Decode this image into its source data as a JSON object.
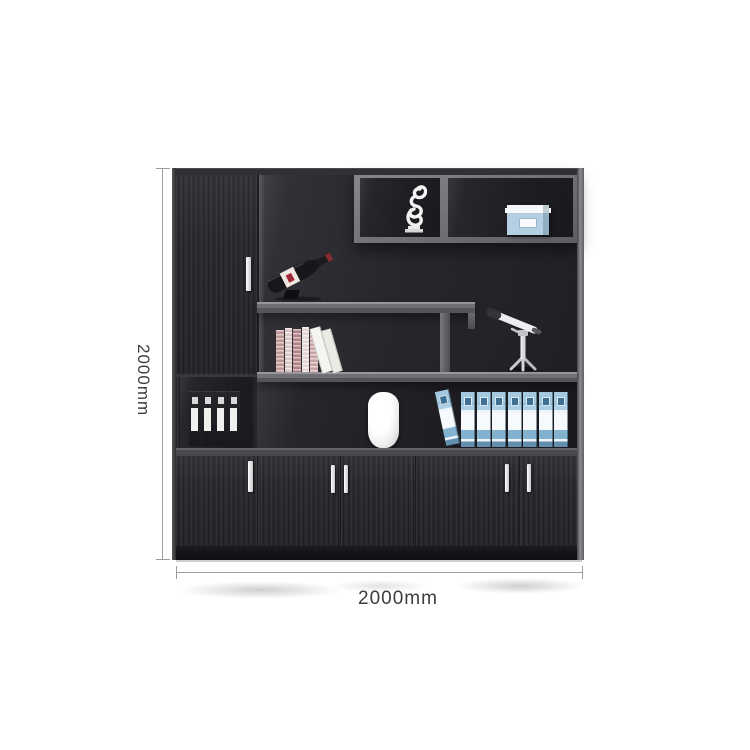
{
  "scene": {
    "type": "furniture-product-photo",
    "background_color": "#ffffff",
    "subject": "black office bookcase filing cabinet with open display shelves and doors"
  },
  "dimensions": {
    "height_label": "2000mm",
    "width_label": "2000mm",
    "height_mm": 2000,
    "width_mm": 2000,
    "line_color": "#9e9e9e",
    "label_color": "#3d3d3d"
  },
  "cabinet": {
    "body_color": "#2a2a2e",
    "shelf_frame_color": "#6f6f75",
    "interior_color": "#232328",
    "handle_color": "#f2f2f2",
    "plinth_color": "#141417",
    "door_count": 5,
    "handle_count": 5,
    "items": [
      {
        "name": "abstract-sculpture",
        "color": "#f4f4f4",
        "location": "top-shelf-left-cell"
      },
      {
        "name": "blue-storage-box",
        "color": "#b4cfe2",
        "location": "top-shelf-right-cell"
      },
      {
        "name": "wine-bottle",
        "color": "#17171b",
        "label_color": "#ede7df",
        "pose": "tilted-on-stand",
        "location": "upper-left-compartment"
      },
      {
        "name": "book-row",
        "count": 7,
        "colors": [
          "#c79e9e",
          "#e7cfcf",
          "#b9898c",
          "#f0e0e0",
          "#f4f4f1"
        ],
        "location": "middle-left-shelf"
      },
      {
        "name": "telescope-model",
        "color": "#ededf0",
        "location": "middle-right-shelf"
      },
      {
        "name": "black-binders",
        "count": 4,
        "color": "#1c1c20",
        "location": "left-open-compartment"
      },
      {
        "name": "white-vase",
        "color": "#fafafa",
        "location": "lower-shelf-left"
      },
      {
        "name": "blue-binders",
        "count": 8,
        "color": "#a9cde4",
        "pose": "first-leaning",
        "location": "lower-shelf-right"
      }
    ]
  }
}
